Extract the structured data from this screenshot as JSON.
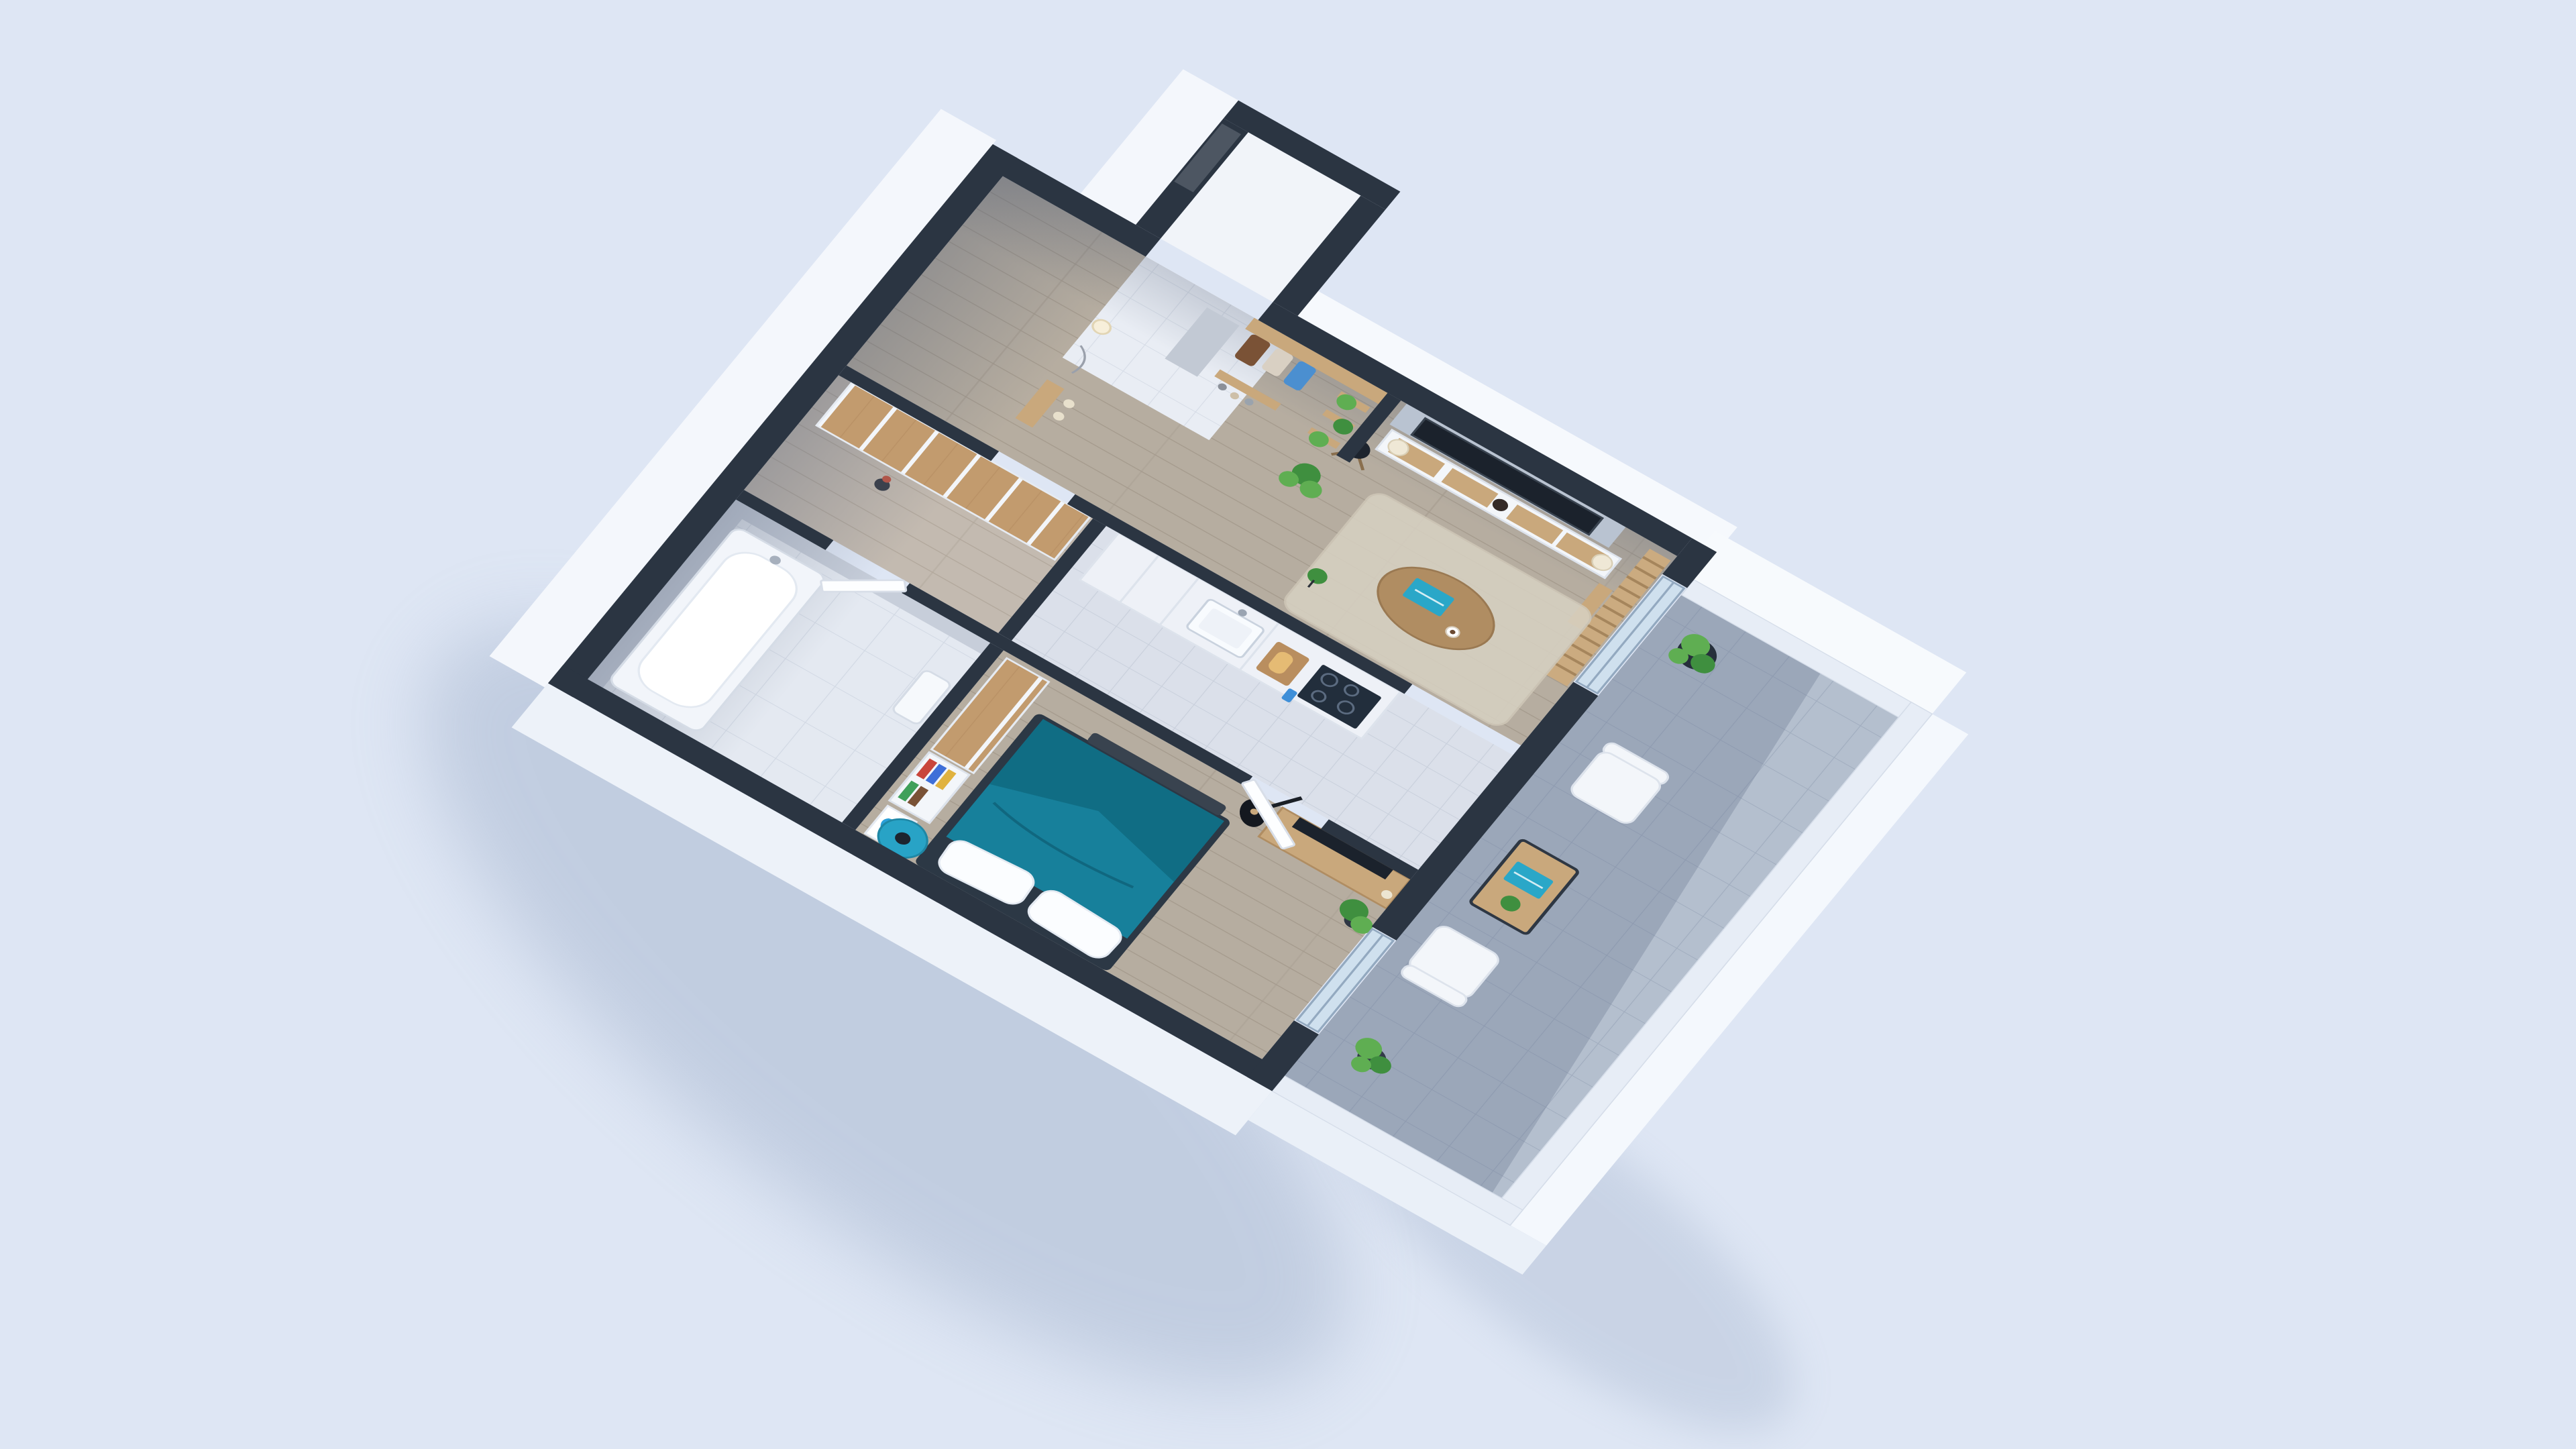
{
  "scene": {
    "title": "3D isometric cutaway floor plan render of a one-bedroom apartment with balcony",
    "type": "architectural-3d-floor-plan",
    "colors": {
      "bg": "#dee6f4",
      "wall": "#2b3542",
      "wallface": "#f4f7fc",
      "wood": "#c9a87c",
      "teal": "#17809b",
      "accent": "#2aa7c8",
      "glass": "#cfe0ee",
      "plant": "#3f8f3f",
      "plant2": "#5fae52",
      "balcony": "#b4bfce"
    },
    "rooms": {
      "vestibule": {
        "label": "Entrance vestibule with dark front door",
        "items": [
          "entry door"
        ]
      },
      "hallway": {
        "label": "Entry hallway",
        "items": [
          "coat rack with hanging clothes",
          "wood shelf",
          "vertical garden plant shelves",
          "shoe shelf with shoes",
          "mirror panel",
          "wall lamp",
          "small console",
          "white tile floor"
        ]
      },
      "living_room": {
        "label": "Living room",
        "items": [
          "wall-mounted TV on stone accent panel",
          "TV console with wood drawers",
          "two table lamps",
          "dark vase",
          "wood slat partition with shelf",
          "black tripod floor lamp",
          "potted plant",
          "area rug",
          "oval wood coffee table",
          "teal book",
          "coffee cup",
          "small plant stand",
          "sliding glass door to balcony"
        ]
      },
      "kitchen": {
        "label": "Kitchen",
        "items": [
          "white cabinet row",
          "marble counter",
          "sink with faucet",
          "gas hob with four burners",
          "cutting board with bread",
          "blue kitchen towel",
          "grey tile floor"
        ]
      },
      "dressing_room": {
        "label": "Dressing room",
        "items": [
          "floor-to-ceiling wood wardrobes",
          "dark vase"
        ]
      },
      "bathroom": {
        "label": "Bathroom",
        "items": [
          "bathtub",
          "marble tiled walls",
          "wash basin",
          "door to dressing room"
        ]
      },
      "bedroom": {
        "label": "Bedroom",
        "items": [
          "double bed with teal duvet",
          "white pillows",
          "dark bench at bed foot",
          "blue round bedside table",
          "black table lamp",
          "wood wardrobe",
          "bookshelf with colorful books",
          "floating wood desk",
          "dark monitor",
          "acoustic guitar on stand",
          "potted plant",
          "blue splash artwork",
          "glass door to balcony"
        ]
      },
      "balcony": {
        "label": "Balcony",
        "items": [
          "white lounge armchair north",
          "white lounge armchair south",
          "wood coffee table with black metal frame",
          "teal book",
          "small potted plant",
          "tall dark planter with plant",
          "potted plant at south corner",
          "stone tile floor",
          "white parapet walls"
        ]
      }
    }
  }
}
